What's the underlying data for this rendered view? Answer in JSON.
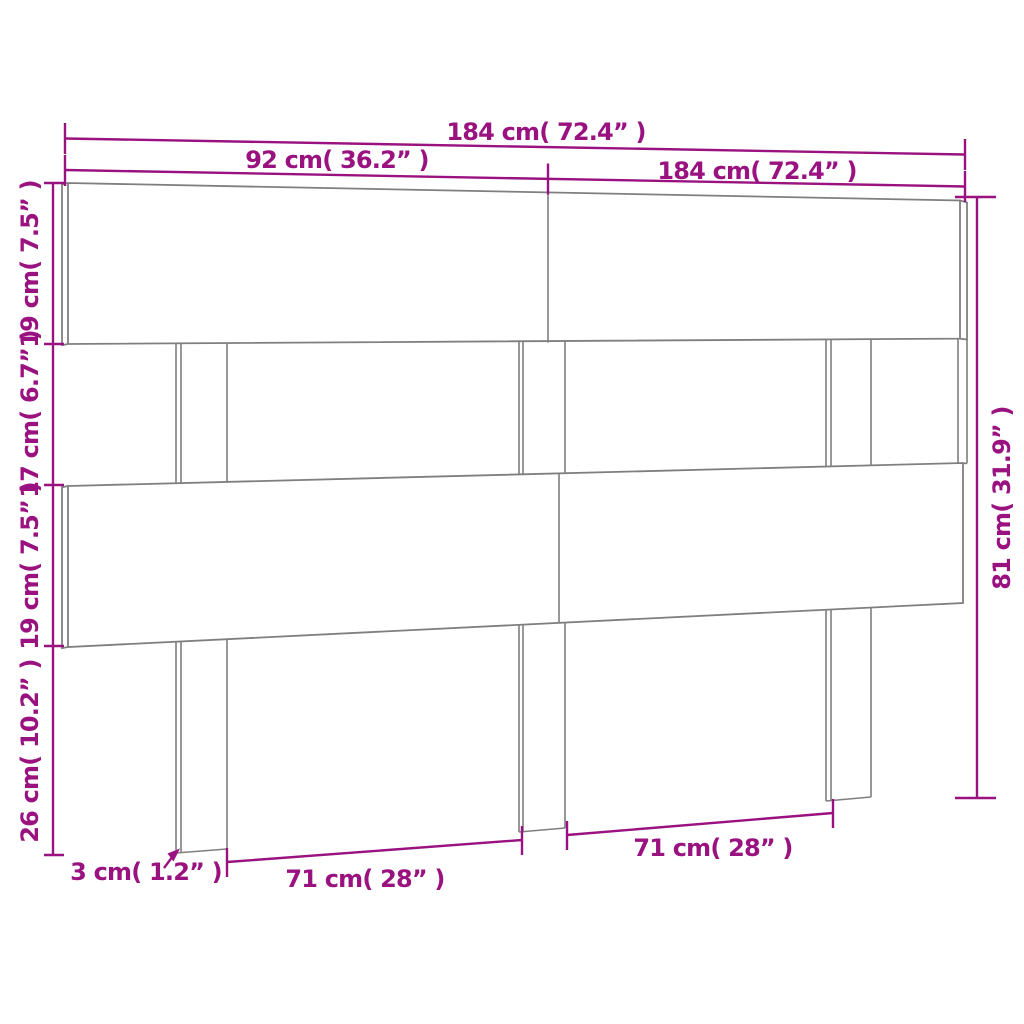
{
  "diagram": {
    "type": "furniture-dimension-drawing",
    "subject": "bed-headboard-three-slats-with-posts"
  },
  "colors": {
    "dimension": "#9a1280",
    "outline": "#7f7f7f",
    "background": "#ffffff"
  },
  "dimensions": {
    "top_total_width": "184 cm( 72.4” )",
    "top_half_width": "92 cm( 36.2” )",
    "top_right_width": "184 cm( 72.4” )",
    "left_top_board_height": "19 cm( 7.5” )",
    "left_gap_height": "17 cm( 6.7” )",
    "left_middle_board_height": "19 cm( 7.5” )",
    "left_leg_height": "26 cm( 10.2” )",
    "right_total_height": "81 cm( 31.9” )",
    "bottom_post_thickness": "3 cm( 1.2” )",
    "bottom_span_left": "71 cm( 28” )",
    "bottom_span_right": "71 cm( 28” )"
  }
}
